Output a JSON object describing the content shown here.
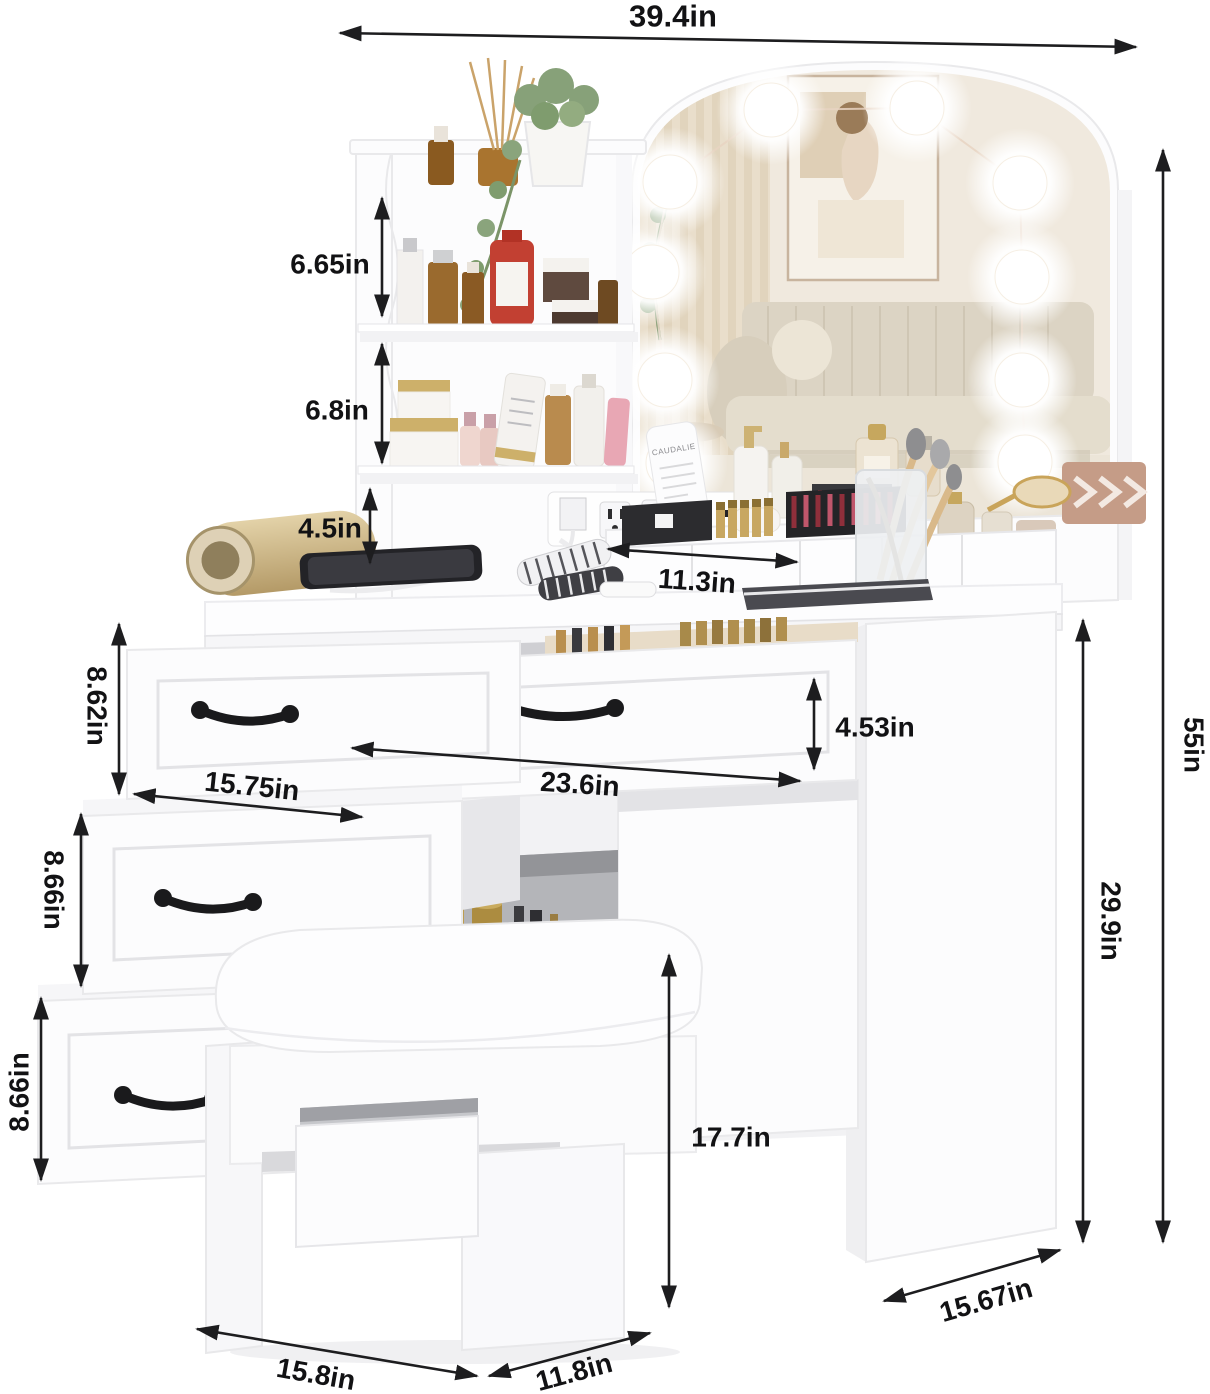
{
  "title": "Vanity desk with lighted mirror, shelves, drawers and storage stool — dimension diagram",
  "dimensions": {
    "total_width": "39.4in",
    "upper_shelf_height": "6.65in",
    "middle_shelf_height": "6.8in",
    "lower_shelf_height": "4.5in",
    "desktop_organizer_width": "11.3in",
    "top_drawer_height": "8.62in",
    "top_drawer_width": "15.75in",
    "center_drawer_width": "23.6in",
    "center_drawer_height": "4.53in",
    "middle_drawer_height": "8.66in",
    "bottom_drawer_height": "8.66in",
    "stool_height": "17.7in",
    "tabletop_height": "29.9in",
    "total_height": "55in",
    "desk_depth": "15.67in",
    "stool_width": "15.8in",
    "stool_depth": "11.8in"
  },
  "products": {
    "tube_label": "CAUDALIE"
  },
  "colors": {
    "furniture": "#fcfcfd",
    "dimension_lines": "#1d1d1f",
    "handles": "#1a1a1c"
  }
}
